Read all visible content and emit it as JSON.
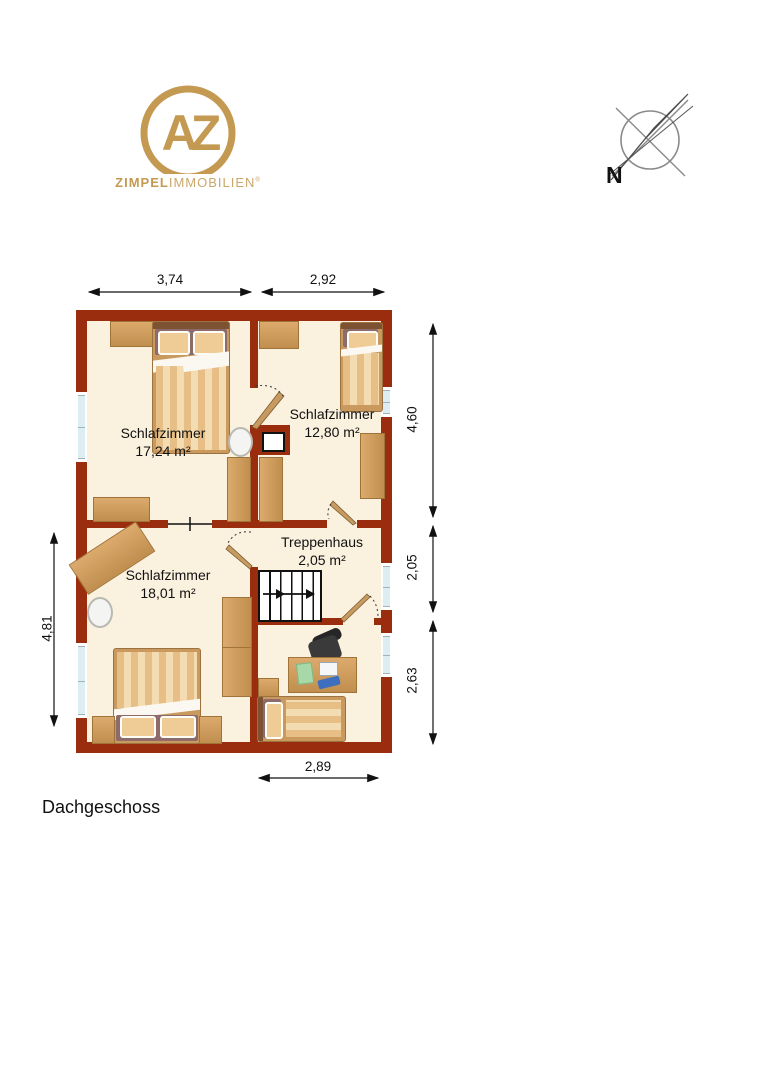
{
  "brand": {
    "monogram": "AZ",
    "name_bold": "ZIMPEL",
    "name_light": "IMMOBILIEN",
    "registered_mark": "®"
  },
  "compass": {
    "north_label": "N"
  },
  "plan": {
    "floor_label": "Dachgeschoss",
    "rooms": [
      {
        "name": "Schlafzimmer",
        "area": "17,24 m²"
      },
      {
        "name": "Schlafzimmer",
        "area": "12,80 m²"
      },
      {
        "name": "Schlafzimmer",
        "area": "18,01 m²"
      },
      {
        "name": "Treppenhaus",
        "area": "2,05 m²"
      }
    ],
    "dimensions": {
      "top_left": "3,74",
      "top_right": "2,92",
      "right_upper": "4,60",
      "right_middle": "2,05",
      "right_lower": "2,63",
      "left": "4,81",
      "bottom": "2,89"
    }
  },
  "colors": {
    "wall": "#9A2D0E",
    "floor": "#FAF1DE",
    "logo_gold": "#C49A52",
    "window_glass": "#DDEEF2"
  }
}
